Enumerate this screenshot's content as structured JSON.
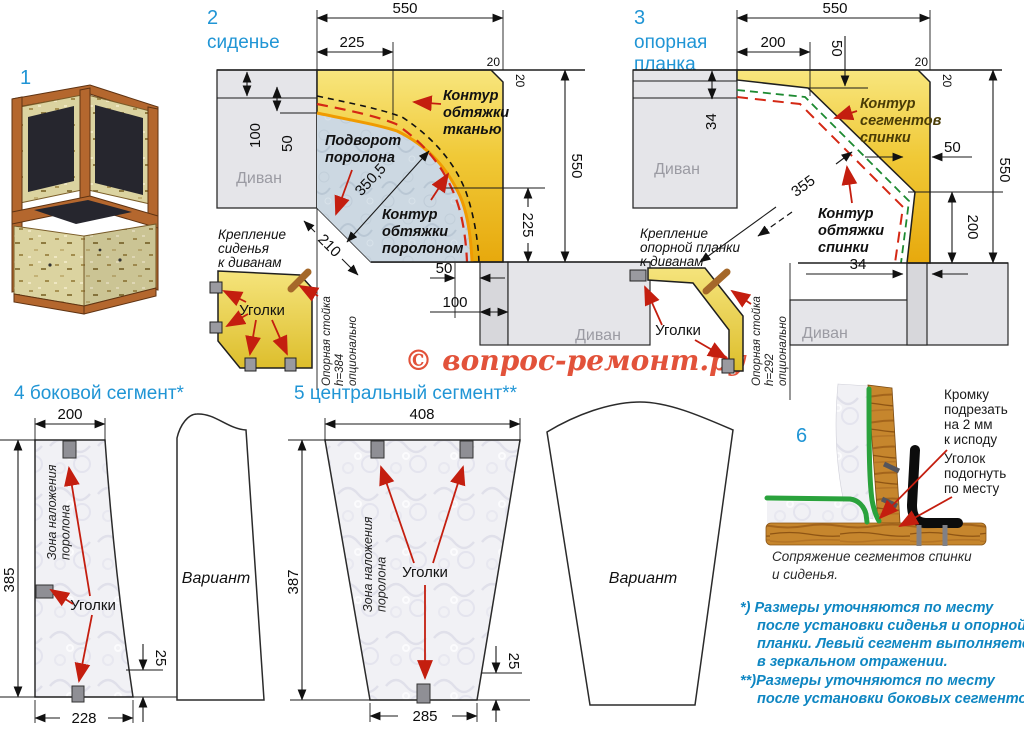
{
  "watermark": "© вопрос-ремонт.ру",
  "common": {
    "divan": "Диван",
    "corners_label": "Уголки",
    "variant_label": "Вариант"
  },
  "s1": {
    "num": "1"
  },
  "s2": {
    "num": "2",
    "title": "сиденье",
    "dims": {
      "top": "550",
      "top_inner": "225",
      "left_outer": "100",
      "left_inner": "50",
      "corner_h": "20",
      "corner_v": "20",
      "right_outer": "550",
      "right_inner": "225",
      "bottom_inner": "50",
      "bottom_outer": "100",
      "diag": "350,5",
      "chamfer": "210"
    },
    "labels": {
      "fabric": [
        "Контур",
        "обтяжки",
        "тканью"
      ],
      "fold": [
        "Подворот",
        "поролона"
      ],
      "foam": [
        "Контур",
        "обтяжки",
        "поролоном"
      ]
    },
    "inset": {
      "title": [
        "Крепление",
        "сиденья",
        "к диванам"
      ],
      "rot": [
        "Опорная стойка",
        "h=384",
        "опционально"
      ]
    }
  },
  "s3": {
    "num": "3",
    "title": [
      "опорная",
      "планка"
    ],
    "dims": {
      "top": "550",
      "top_inner": "200",
      "drop": "50",
      "corner_h": "20",
      "corner_v": "20",
      "left": "34",
      "diag": "355",
      "strip": "50",
      "right_outer": "550",
      "right_inner": "200",
      "bottom": "34"
    },
    "labels": {
      "segments": [
        "Контур",
        "сегментов",
        "спинки"
      ],
      "cover": [
        "Контур",
        "обтяжки",
        "спинки"
      ]
    },
    "inset": {
      "title": [
        "Крепление",
        "опорной планки",
        "к диванам"
      ],
      "rot": [
        "Опорная стойка",
        "h=292",
        "опционально"
      ]
    }
  },
  "s4": {
    "title": "4 боковой сегмент*",
    "dims": {
      "top": "200",
      "left": "385",
      "bottom": "228",
      "offset": "25"
    },
    "zone": [
      "Зона наложения",
      "поролона"
    ]
  },
  "s5": {
    "title": "5 центральный сегмент**",
    "dims": {
      "top": "408",
      "left": "387",
      "bottom": "285",
      "offset": "25"
    },
    "zone": [
      "Зона наложения",
      "поролона"
    ]
  },
  "s6": {
    "num": "6",
    "trim": [
      "Кромку",
      "подрезать",
      "на 2 мм",
      "к исподу"
    ],
    "bend": [
      "Уголок",
      "подогнуть",
      "по месту"
    ],
    "caption": [
      "Сопряжение сегментов спинки",
      "и сиденья."
    ]
  },
  "footnotes": [
    "*)  Размеры уточняются по месту",
    "после установки сиденья и опорной",
    "планки. Левый сегмент выполняется",
    "в зеркальном отражении.",
    "**)Размеры уточняются по месту",
    "после установки боковых сегментов."
  ]
}
